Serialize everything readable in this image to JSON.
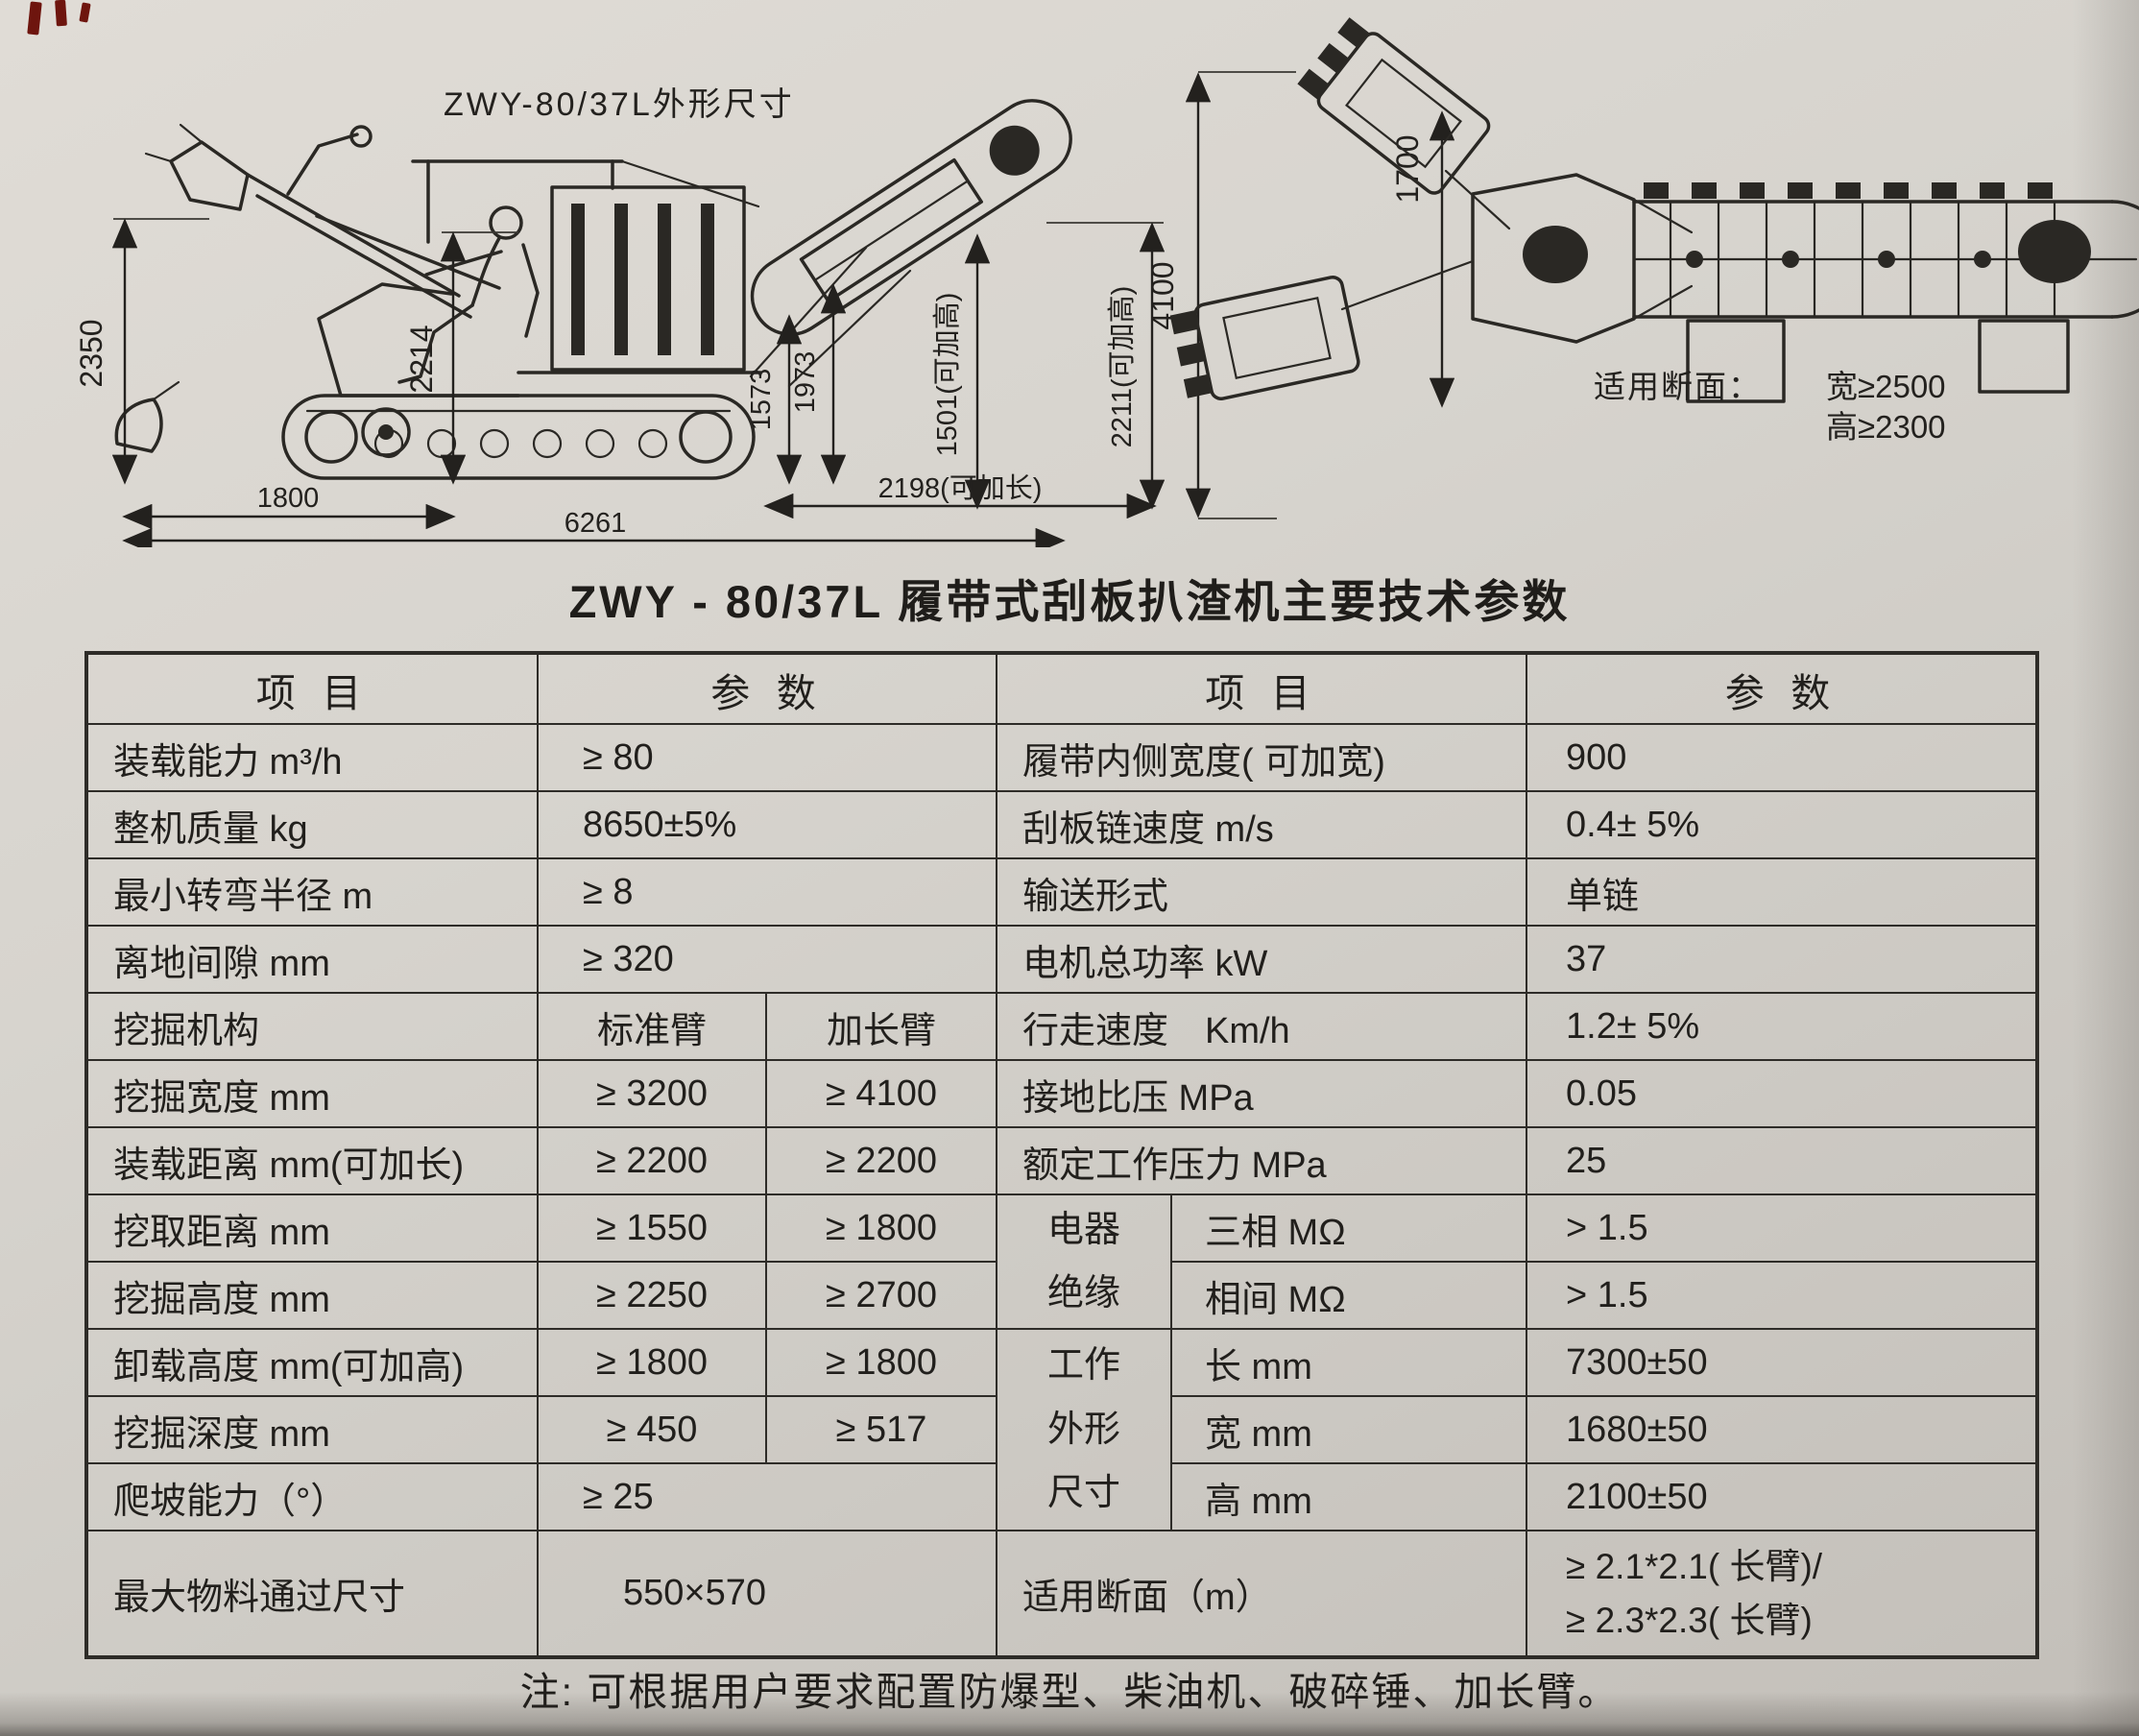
{
  "page": {
    "title": "ZWY - 80/37L 履带式刮板扒渣机主要技术参数",
    "note": "注: 可根据用户要求配置防爆型、柴油机、破碎锤、加长臂。"
  },
  "accents": {
    "corner_mark_color": "#6e150e",
    "paper_color": "#d7d4ce",
    "ink_color": "#2a2824"
  },
  "drawings": {
    "side": {
      "caption": "ZWY-80/37L外形尺寸",
      "dim_2350": "2350",
      "dim_2214": "2214",
      "dim_1573": "1573",
      "dim_1973": "1973",
      "dim_1501": "1501(可加高)",
      "dim_2211": "2211(可加高)",
      "dim_1800": "1800",
      "dim_6261": "6261",
      "dim_2198": "2198(可加长)"
    },
    "top": {
      "dim_4100": "4100",
      "dim_1700": "1700",
      "section_label": "适用断面：",
      "section_width": "宽≥2500",
      "section_height": "高≥2300"
    }
  },
  "table": {
    "header": {
      "item_l": "项 目",
      "param_l": "参 数",
      "item_r": "项 目",
      "param_r": "参 数"
    },
    "left": [
      {
        "item": "装载能力 m³/h",
        "value": "≥ 80"
      },
      {
        "item": "整机质量 kg",
        "value": "8650±5%"
      },
      {
        "item": "最小转弯半径 m",
        "value": "≥ 8"
      },
      {
        "item": "离地间隙 mm",
        "value": "≥ 320"
      },
      {
        "item": "挖掘机构",
        "std": "标准臂",
        "ext": "加长臂"
      },
      {
        "item": "挖掘宽度 mm",
        "std": "≥ 3200",
        "ext": "≥ 4100"
      },
      {
        "item": "装载距离 mm(可加长)",
        "std": "≥ 2200",
        "ext": "≥ 2200"
      },
      {
        "item": "挖取距离 mm",
        "std": "≥ 1550",
        "ext": "≥ 1800"
      },
      {
        "item": "挖掘高度 mm",
        "std": "≥ 2250",
        "ext": "≥ 2700"
      },
      {
        "item": "卸载高度 mm(可加高)",
        "std": "≥ 1800",
        "ext": "≥ 1800"
      },
      {
        "item": "挖掘深度 mm",
        "std": "≥ 450",
        "ext": "≥ 517"
      },
      {
        "item": "爬坡能力（°）",
        "value": "≥ 25"
      },
      {
        "item": "最大物料通过尺寸",
        "value": "550×570"
      }
    ],
    "right": [
      {
        "item": "履带内侧宽度( 可加宽)",
        "value": "900"
      },
      {
        "item": "刮板链速度 m/s",
        "value": "0.4± 5%"
      },
      {
        "item": "输送形式",
        "value": "单链"
      },
      {
        "item": "电机总功率 kW",
        "value": "37"
      },
      {
        "item": "行走速度　Km/h",
        "value": "1.2± 5%"
      },
      {
        "item": "接地比压 MPa",
        "value": "0.05"
      },
      {
        "item": "额定工作压力 MPa",
        "value": "25"
      },
      {
        "group_line1": "电器",
        "group_line2": "绝缘",
        "sub": "三相 MΩ",
        "value": "> 1.5"
      },
      {
        "sub": "相间 MΩ",
        "value": "> 1.5"
      },
      {
        "group_line1": "工作",
        "group_line2": "外形",
        "group_line3": "尺寸",
        "sub": "长 mm",
        "value": "7300±50"
      },
      {
        "sub": "宽 mm",
        "value": "1680±50"
      },
      {
        "sub": "高 mm",
        "value": "2100±50"
      },
      {
        "item": "适用断面（m）",
        "value_line1": "≥ 2.1*2.1( 长臂)/",
        "value_line2": "≥ 2.3*2.3( 长臂)"
      }
    ]
  }
}
